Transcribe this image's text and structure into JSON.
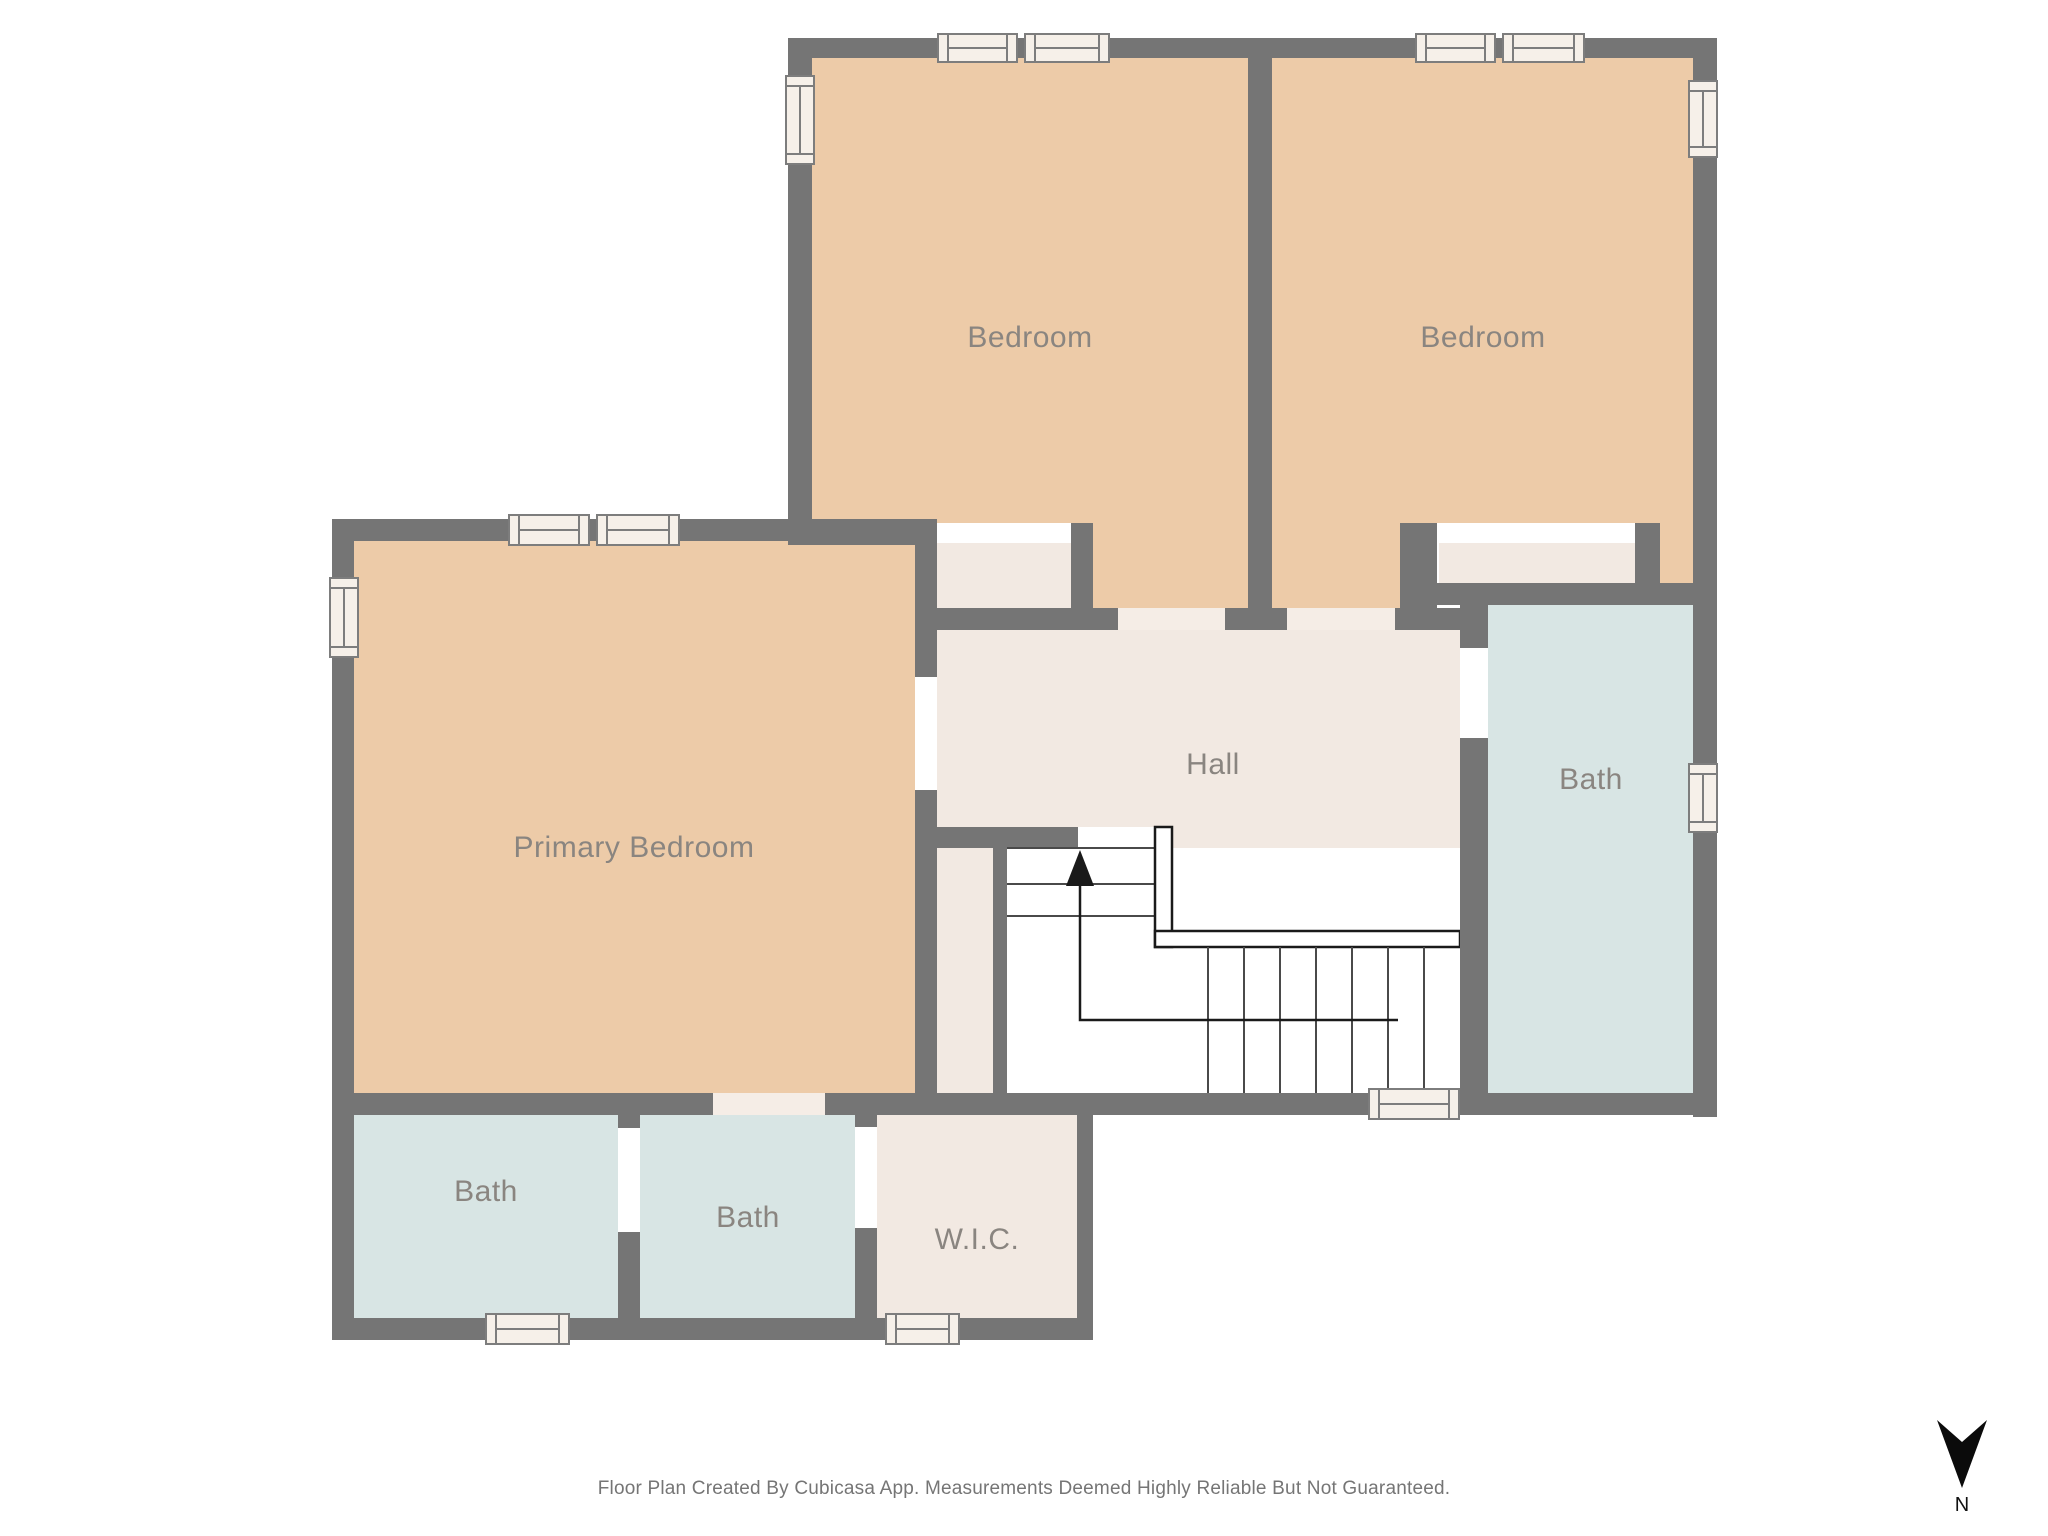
{
  "rooms": {
    "bedroom_left": {
      "label": "Bedroom"
    },
    "bedroom_right": {
      "label": "Bedroom"
    },
    "primary_bedroom": {
      "label": "Primary Bedroom"
    },
    "hall": {
      "label": "Hall"
    },
    "bath_upper": {
      "label": "Bath"
    },
    "bath_lower_left": {
      "label": "Bath"
    },
    "bath_lower_mid": {
      "label": "Bath"
    },
    "wic": {
      "label": "W.I.C."
    }
  },
  "stairs": {
    "direction": "up"
  },
  "compass": {
    "label": "N"
  },
  "footer": {
    "disclaimer": "Floor Plan Created By Cubicasa App. Measurements Deemed Highly Reliable But Not Guaranteed."
  },
  "palette": {
    "wall": "#757575",
    "bedroom_floor": "#EDCBA8",
    "hall_floor": "#F2E9E2",
    "bath_floor": "#D8E5E4",
    "window_fill": "#F6F0E9",
    "door_gap": "#F5EDE6",
    "background": "#FFFFFF",
    "label_text": "#8A8580",
    "footer_text": "#757575"
  }
}
